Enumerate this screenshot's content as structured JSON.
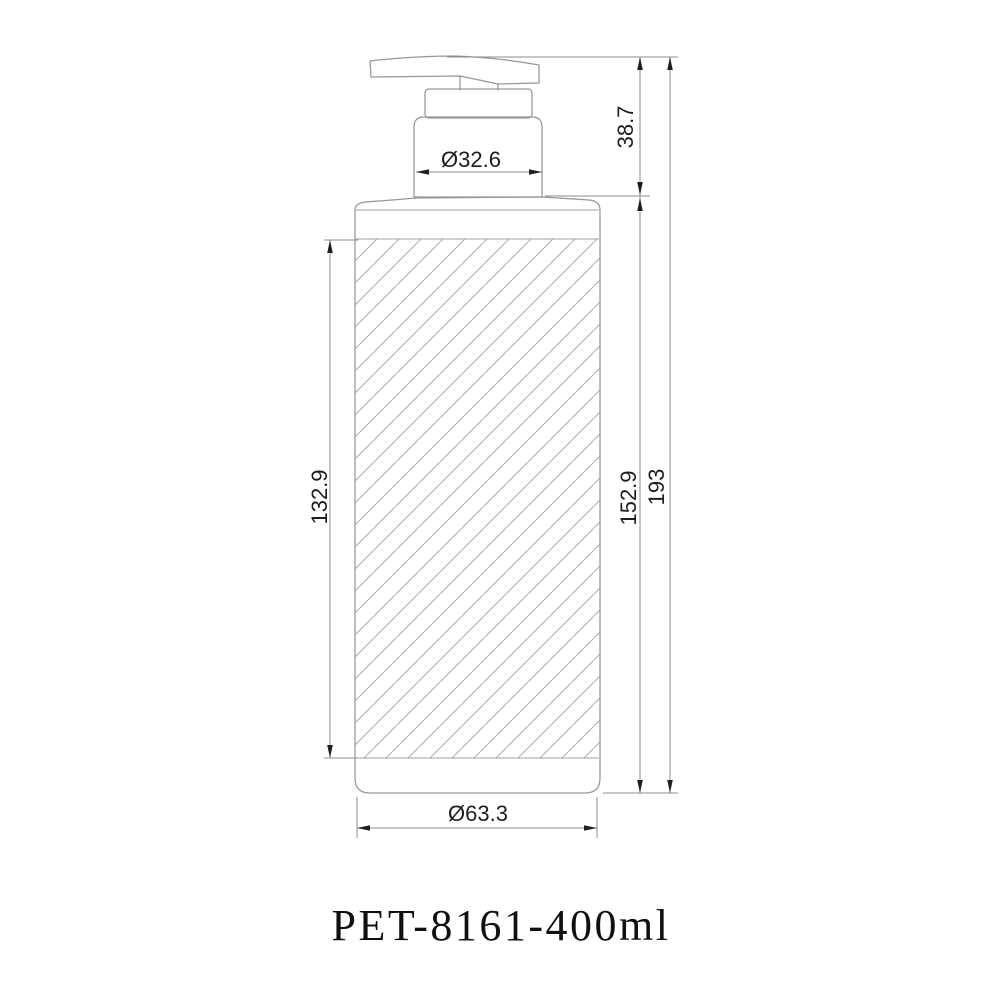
{
  "drawing": {
    "title": "PET-8161-400ml",
    "product_type": "pump-bottle-technical-drawing",
    "dimensions": {
      "neck_diameter": "Ø32.6",
      "pump_height": "38.7",
      "label_panel_height": "132.9",
      "body_height": "152.9",
      "total_height": "193",
      "base_diameter": "Ø63.3"
    },
    "colors": {
      "background": "#ffffff",
      "outline": "#979797",
      "hatch": "#ababab",
      "dimension_line": "#8d8d8d",
      "dimension_text": "#1d1d1d",
      "title_text": "#101010"
    }
  }
}
